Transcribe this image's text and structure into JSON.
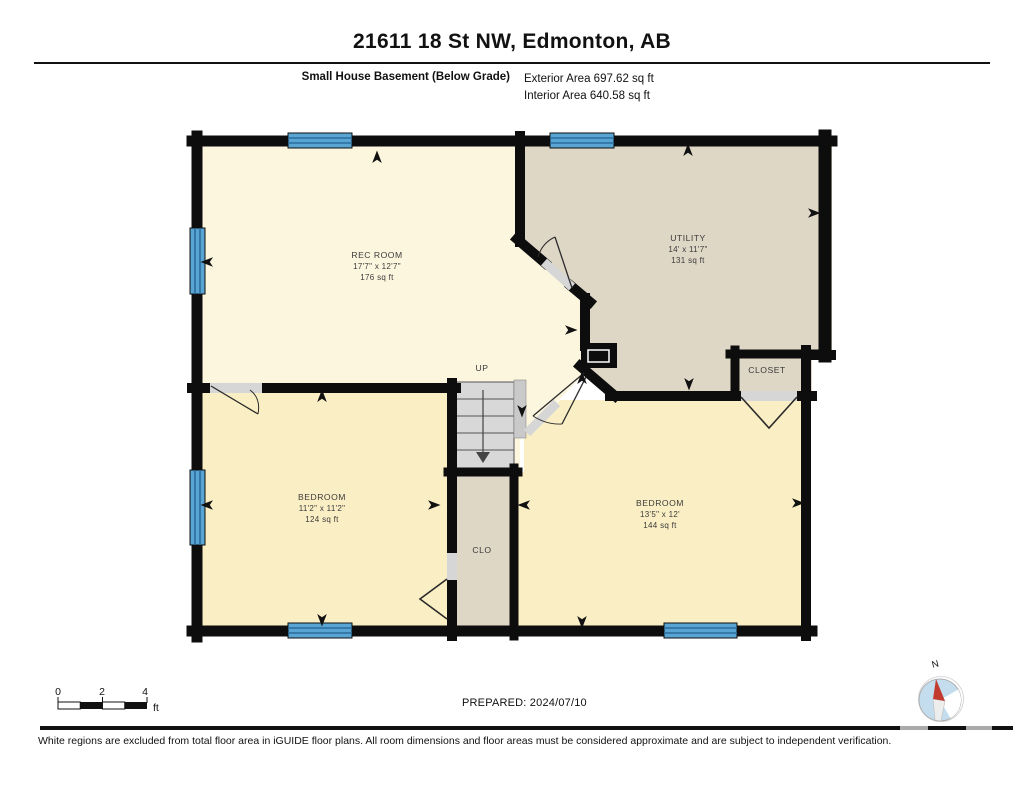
{
  "header": {
    "title": "21611 18 St NW, Edmonton, AB",
    "floor_label": "Small House Basement (Below Grade)",
    "exterior_area": "Exterior Area 697.62 sq ft",
    "interior_area": "Interior Area 640.58 sq ft"
  },
  "rooms": {
    "rec_room": {
      "name": "REC ROOM",
      "dims": "17'7\" x 12'7\"",
      "area": "176 sq ft"
    },
    "utility": {
      "name": "UTILITY",
      "dims": "14' x 11'7\"",
      "area": "131 sq ft"
    },
    "closet": {
      "name": "CLOSET"
    },
    "bedroom_left": {
      "name": "BEDROOM",
      "dims": "11'2\" x 11'2\"",
      "area": "124 sq ft"
    },
    "bedroom_right": {
      "name": "BEDROOM",
      "dims": "13'5\" x 12'",
      "area": "144 sq ft"
    },
    "clo": {
      "name": "CLO"
    },
    "stairs": {
      "label": "UP"
    }
  },
  "footer": {
    "scale": {
      "t0": "0",
      "t1": "2",
      "t2": "4",
      "unit": "ft"
    },
    "prepared": "PREPARED: 2024/07/10",
    "compass_n": "N",
    "disclaimer": "White regions are excluded from total floor area in iGUIDE floor plans. All room dimensions and floor areas must be considered approximate and are subject to independent verification."
  },
  "colors": {
    "wall": "#0d0d0d",
    "rec_room_fill": "#FCF6DF",
    "utility_fill": "#DFD7C6",
    "bedroom_fill": "#FAEFC4",
    "stairs_fill": "#D8D8D8",
    "window_blue": "#58A5D4",
    "window_stripe": "#2B6C9B",
    "threshold_gray": "#D6D6D6",
    "compass_blue": "#C3DDEF",
    "compass_needle_red": "#C23B2E"
  }
}
